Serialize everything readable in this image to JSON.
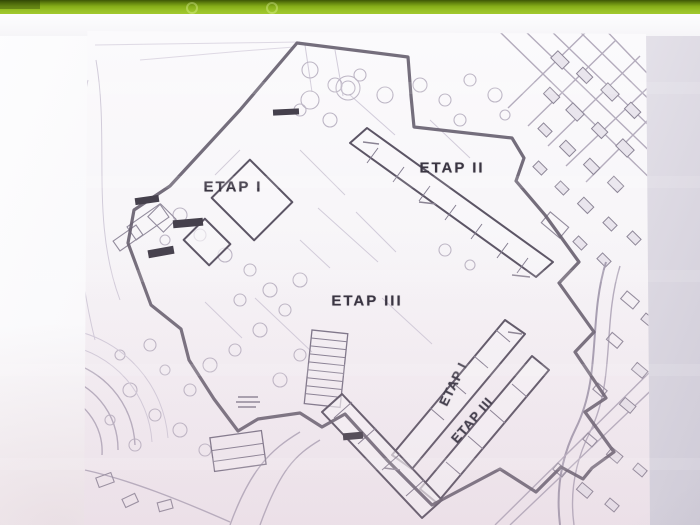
{
  "scene": {
    "kind": "photograph of a projected slide showing a scanned architectural site plan",
    "slide_bar_color": "#8fba1f",
    "paper_color": "#faf9fb",
    "boundary_color": "#665e6f",
    "label_color": "#3a3542"
  },
  "map": {
    "kind": "site development plan with construction stages",
    "stage_labels": [
      {
        "id": "etap-1",
        "text": "ETAP I",
        "rotation_deg": 0
      },
      {
        "id": "etap-2",
        "text": "ETAP II",
        "rotation_deg": 0
      },
      {
        "id": "etap-3",
        "text": "ETAP III",
        "rotation_deg": 0
      },
      {
        "id": "etap-1-rotated",
        "text": "ETAP I",
        "rotation_deg": -64
      },
      {
        "id": "etap-3-rotated",
        "text": "ETAP III",
        "rotation_deg": -49
      }
    ]
  }
}
